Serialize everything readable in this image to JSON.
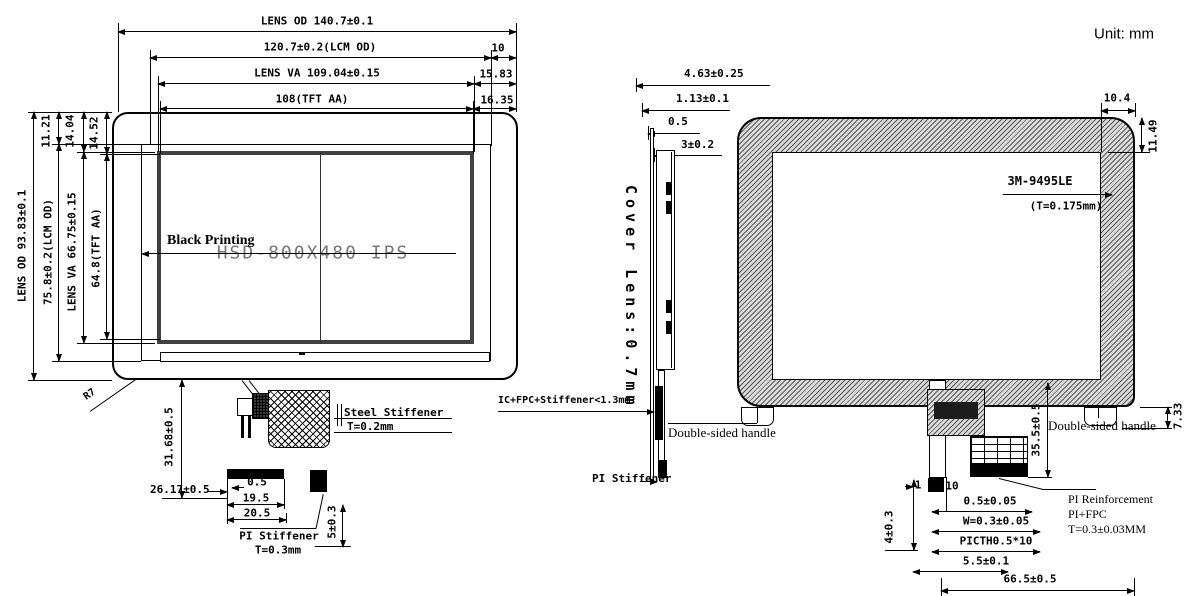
{
  "unit_label": "Unit: mm",
  "front": {
    "dim_lens_od_w": "LENS OD 140.7±0.1",
    "dim_lcm_od_w": "120.7±0.2(LCM OD)",
    "dim_lens_va_w": "LENS VA 109.04±0.15",
    "dim_tft_aa_w": "108(TFT AA)",
    "dim_right_10": "10",
    "dim_right_1583": "15.83",
    "dim_right_1635": "16.35",
    "dim_lens_od_h": "LENS OD 93.83±0.1",
    "dim_lcm_od_h": "75.8±0.2(LCM OD)",
    "dim_lens_va_h": "LENS VA 66.75±0.15",
    "dim_tft_aa_h": "64.8(TFT AA)",
    "dim_top_1121": "11.21",
    "dim_top_1404": "14.04",
    "dim_top_1452": "14.52",
    "black_printing": "Black Printing",
    "watermark": "HSD-800X480 IPS",
    "radius_label": "R7",
    "steel_stiffener": "Steel Stiffener",
    "steel_stiffener_t": "T=0.2mm",
    "dim_3168": "31.68±0.5",
    "dim_2617": "26.17±0.5",
    "dim_05": "0.5",
    "dim_195": "19.5",
    "dim_205": "20.5",
    "dim_5": "5±0.3",
    "pi_stiffener": "PI Stiffener",
    "pi_stiffener_t": "T=0.3mm"
  },
  "side": {
    "dim_463": "4.63±0.25",
    "dim_113": "1.13±0.1",
    "dim_05": "0.5",
    "dim_3": "3±0.2",
    "cover_lens": "Cover Lens:0.7mm",
    "stack": "IC+FPC+Stiffener<1.3mm",
    "pi_stiffener": "PI Stiffener"
  },
  "rear": {
    "dim_104": "10.4",
    "dim_1149": "11.49",
    "adhesive": "3M-9495LE",
    "adhesive_t": "(T=0.175mm)",
    "handle_left": "Double-sided handle",
    "handle_right": "Double-sided handle",
    "dim_733": "7.33",
    "dim_355": "35.5±0.5",
    "dim_1": "1",
    "dim_10": "10",
    "dim_4": "4±0.3",
    "dim_0505": "0.5±0.05",
    "dim_w03": "W=0.3±0.05",
    "dim_pitch": "PICTH0.5*10",
    "dim_55": "5.5±0.1",
    "dim_665": "66.5±0.5",
    "reinf_1": "PI Reinforcement",
    "reinf_2": "PI+FPC",
    "reinf_3": "T=0.3±0.03MM"
  }
}
